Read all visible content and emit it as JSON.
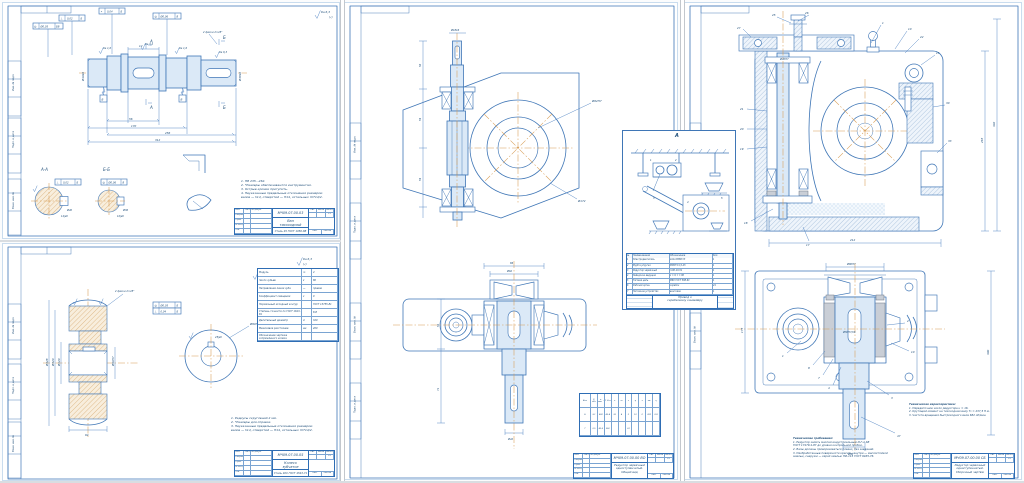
{
  "palette": {
    "line": "#3f76b6",
    "centerline": "#d79b52",
    "paper": "#ffffff",
    "hatch_tan": "#cf9a55",
    "hatch_blue": "#7fa3c9"
  },
  "tb": {
    "h1": "Изм.",
    "h2": "Лист",
    "h3": "№ докум.",
    "h4": "Подп.",
    "h5": "Дата",
    "r1": "Разраб.",
    "r2": "Пров.",
    "r3": "Т.контр.",
    "r4": "Н.контр.",
    "r5": "Утв.",
    "lit": "Лит.",
    "mass": "Масса",
    "scale": "Масштаб",
    "list": "Лист",
    "listov": "Листов",
    "group": "группа ГП9-46"
  },
  "margin": {
    "m1": "Инв. № подл.",
    "m2": "Подп. и дата",
    "m3": "Взам. инв. №"
  },
  "shaft": {
    "doc": "МЧ09.07.00.03",
    "title1": "Вал",
    "title2": "тихоходный",
    "material": "Сталь 45 ГОСТ 1050-88",
    "scale": "1:1",
    "sec_a": "А-А",
    "sec_b": "Б-Б",
    "mk_a": "А",
    "mk_b": "Б",
    "dat_b": "Б",
    "dat_v": "В",
    "dims": {
      "dl": "Ø40k6",
      "dr": "Ø38k6",
      "l1": "56",
      "l2": "170",
      "l3": "256",
      "l4": "312",
      "k": "12",
      "ch": "2 фаски 2×45°"
    },
    "tol": {
      "s1": "⊥",
      "v1": "0,02",
      "d1": "Б",
      "s2": "◎",
      "v2": "Ø0,05",
      "d2": "БВ",
      "s3": "⌖",
      "v3": "0,04",
      "d3": "Б",
      "s4": "◎",
      "v4": "Ø0,06",
      "d4": "В"
    },
    "rough": {
      "r1": "Ra 1,6",
      "r2": "Ra 3,2",
      "r3": "Ra 6,3",
      "corner": "Ra 6,3",
      "br": "(√)"
    },
    "sec_dims": {
      "a": "Ø40",
      "b": "Ø36",
      "ka": "12js9",
      "kb": "10js9"
    },
    "notes": [
      "1. НВ 235...262.",
      "2. *Размеры обеспечиваются инструментом.",
      "3. Острые кромки притупить.",
      "4. Неуказанные предельные отклонения размеров:",
      "валов — h14, отверстий — Н14, остальных ±IT14/2."
    ]
  },
  "gear": {
    "doc": "МЧ09.07.00.05",
    "title1": "Колесо",
    "title2": "зубчатое",
    "material": "Сталь 40Х ГОСТ 4543-71",
    "scale": "1:2",
    "params": [
      [
        "Модуль",
        "m",
        "4"
      ],
      [
        "Число зубьев",
        "z",
        "80"
      ],
      [
        "Направление линии зуба",
        "—",
        "правое"
      ],
      [
        "Коэффициент смещения",
        "x",
        "0"
      ],
      [
        "Нормальный исходный контур",
        "",
        "ГОСТ 13755-81"
      ],
      [
        "Степень точности по ГОСТ 1643-81",
        "",
        "8-В"
      ],
      [
        "Делительный диаметр",
        "d",
        "320"
      ],
      [
        "Межосевое расстояние",
        "aw",
        "200"
      ],
      [
        "Обозначение чертежа сопряжённого колеса",
        "",
        ""
      ]
    ],
    "dims": {
      "da": "Ø328",
      "d": "Ø320",
      "dh": "Ø120",
      "bore": "Ø90H7",
      "w": "64",
      "key": "25js9",
      "ch": "2 фаски 2×45°",
      "lead": "Ø90H7"
    },
    "tol": {
      "s1": "◎",
      "v1": "Ø0,05",
      "d1": "Б",
      "s2": "⊥",
      "v2": "0,04",
      "d2": "Б"
    },
    "rough": {
      "corner": "Ra 6,3",
      "br": "(√)",
      "r1": "Ra 1,6",
      "r2": "Ra 3,2"
    },
    "notes": [
      "1. Радиусы скруглений 2 мм.",
      "2. *Размеры для справок.",
      "3. Неуказанные предельные отклонения размеров:",
      "валов — h14, отверстий — Н14, остальных ±IT14/2."
    ]
  },
  "mid": {
    "doc": "МЧ09.07.00.00 ВО",
    "t1": "Редуктор червячный",
    "t2": "одноступенчатый.",
    "t3": "Общий вид",
    "scale": "1:2",
    "dims": {
      "tip": "Ø18k6",
      "c1": "56",
      "c2": "59",
      "c3": "59",
      "bore": "Ø62H7",
      "da": "Ø172",
      "brg": "Ø62",
      "span": "86",
      "out": "Ø42",
      "v1": "52",
      "v2": "74"
    },
    "table": {
      "header": [
        "Вал",
        "P, кВт",
        "n, мин⁻¹",
        "T, Н·м",
        "u",
        "m",
        "z",
        "q",
        "x",
        "aw",
        "η"
      ],
      "r1": [
        "Б",
        "3,1",
        "682",
        "43,4",
        "16",
        "4",
        "2",
        "10",
        "0",
        "200",
        "0,8"
      ],
      "r2": [
        "Т",
        "2,5",
        "42,6",
        "560",
        "",
        "",
        "32",
        "",
        "",
        "",
        ""
      ]
    }
  },
  "asm": {
    "doc": "МЧ09.07.00.00 СБ",
    "t1": "Редуктор червячный",
    "t2": "одноступенчатый.",
    "t3": "Сборочный чертёж",
    "scale": "1:2",
    "lead": [
      "27",
      "25",
      "26",
      "1",
      "10",
      "22",
      "15",
      "30",
      "33",
      "21",
      "20",
      "19",
      "18",
      "17"
    ],
    "lead2": [
      "1",
      "8",
      "7",
      "4",
      "3",
      "10",
      "2",
      "47"
    ],
    "dims": {
      "w": "212",
      "h": "265",
      "d": "302",
      "bore": "Ø50H7/k6",
      "flange": "Ø80H7",
      "span": "86js6",
      "foot": "175",
      "depth": "300",
      "out": "Ø36",
      "top": "Ø40H7"
    },
    "tt_title": "Технические требования:",
    "tt": [
      "1. Редуктор залить маслом индустриальным И-Г-А-68",
      "ГОСТ 17479.4-87 до уровня контрольной пробки.",
      "2. Валы должны проворачиваться плавно, без заеданий.",
      "3. Необработанные поверхности красить: внутри — маслостойкой",
      "эмалью, снаружи — серой эмалью ПФ-115 ГОСТ 6465-76."
    ],
    "th_title": "Техническая характеристика:",
    "th": [
      "1. Передаточное число редуктора u = 16.",
      "2. Крутящий момент на тихоходном валу Т₂ = 237,5 Н·м.",
      "3. Частота вращения быстроходного вала 682 об/мин."
    ]
  },
  "inset": {
    "mark": "А",
    "doc": "МЧ09.07.00.00",
    "t1": "Привод к",
    "t2": "скребковому конвейеру",
    "lead": [
      "1",
      "2",
      "3",
      "4",
      "5"
    ],
    "table": {
      "headers": [
        "№",
        "Наименование",
        "Обозначение",
        "Кол."
      ],
      "rows": [
        [
          "1",
          "Электродвигатель",
          "4А112МВ6 УЗ",
          "1"
        ],
        [
          "2",
          "Муфта упругая",
          "МУВП 31,5-25",
          "1"
        ],
        [
          "3",
          "Редуктор червячный",
          "Ч-80-16-51",
          "1"
        ],
        [
          "4",
          "Звёздочка ведущая",
          "z = 9; t = 80",
          "1"
        ],
        [
          "5",
          "Тяговая цепь",
          "М80 ГОСТ 588-81",
          "1"
        ],
        [
          "6",
          "Рабочий орган",
          "скребок",
          "24"
        ],
        [
          "7",
          "Натяжное устройство",
          "винтовое",
          "1"
        ]
      ]
    }
  }
}
